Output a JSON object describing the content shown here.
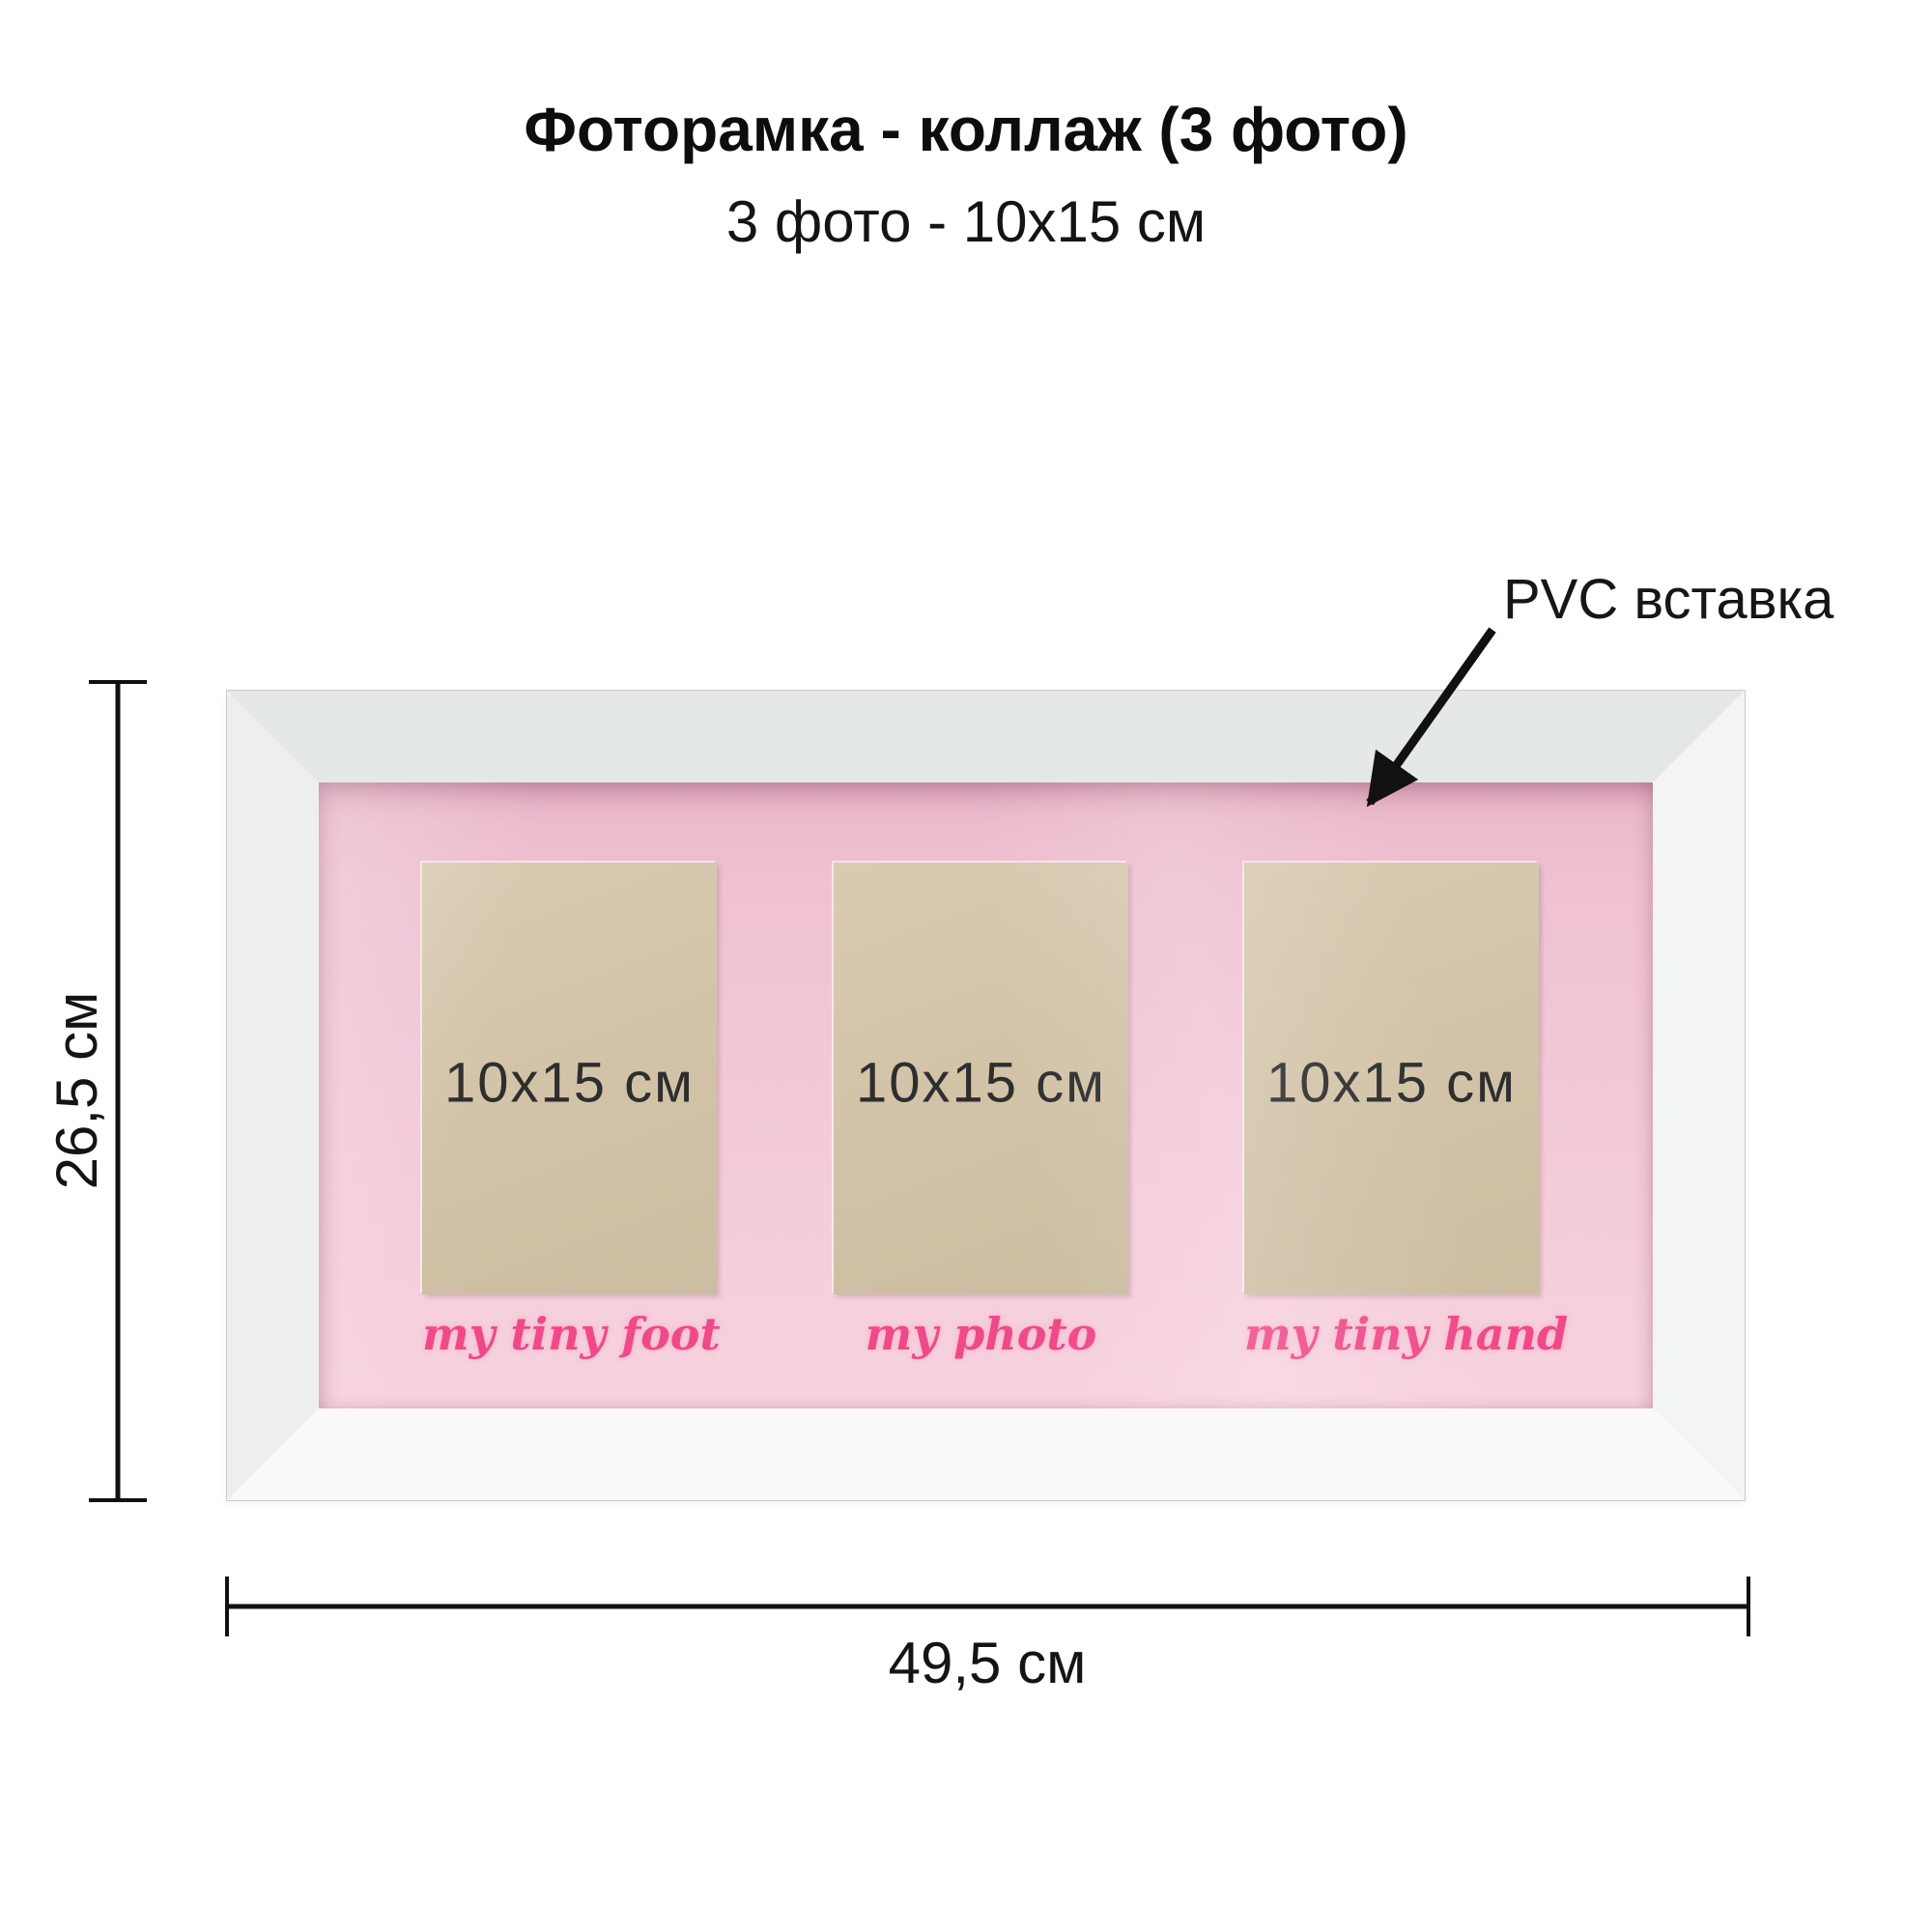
{
  "title": "Фоторамка - коллаж (3 фото)",
  "subtitle": "3 фото - 10х15 см",
  "annotation": {
    "label": "PVC вставка"
  },
  "frame": {
    "slots": [
      {
        "size_label": "10х15 см",
        "caption": "my tiny foot"
      },
      {
        "size_label": "10х15 см",
        "caption": "my photo"
      },
      {
        "size_label": "10х15 см",
        "caption": "my tiny hand"
      }
    ]
  },
  "dimensions": {
    "height_label": "26,5 см",
    "width_label": "49,5 см"
  },
  "colors": {
    "background": "#ffffff",
    "frame_face": "#e5e9e6",
    "mat_pink": "#f3c9d8",
    "mat_shadow_pink": "#c98fa8",
    "slot_kraft": "#d3c4a9",
    "caption_pink": "#f0498a",
    "annotation_ink": "#111111"
  }
}
